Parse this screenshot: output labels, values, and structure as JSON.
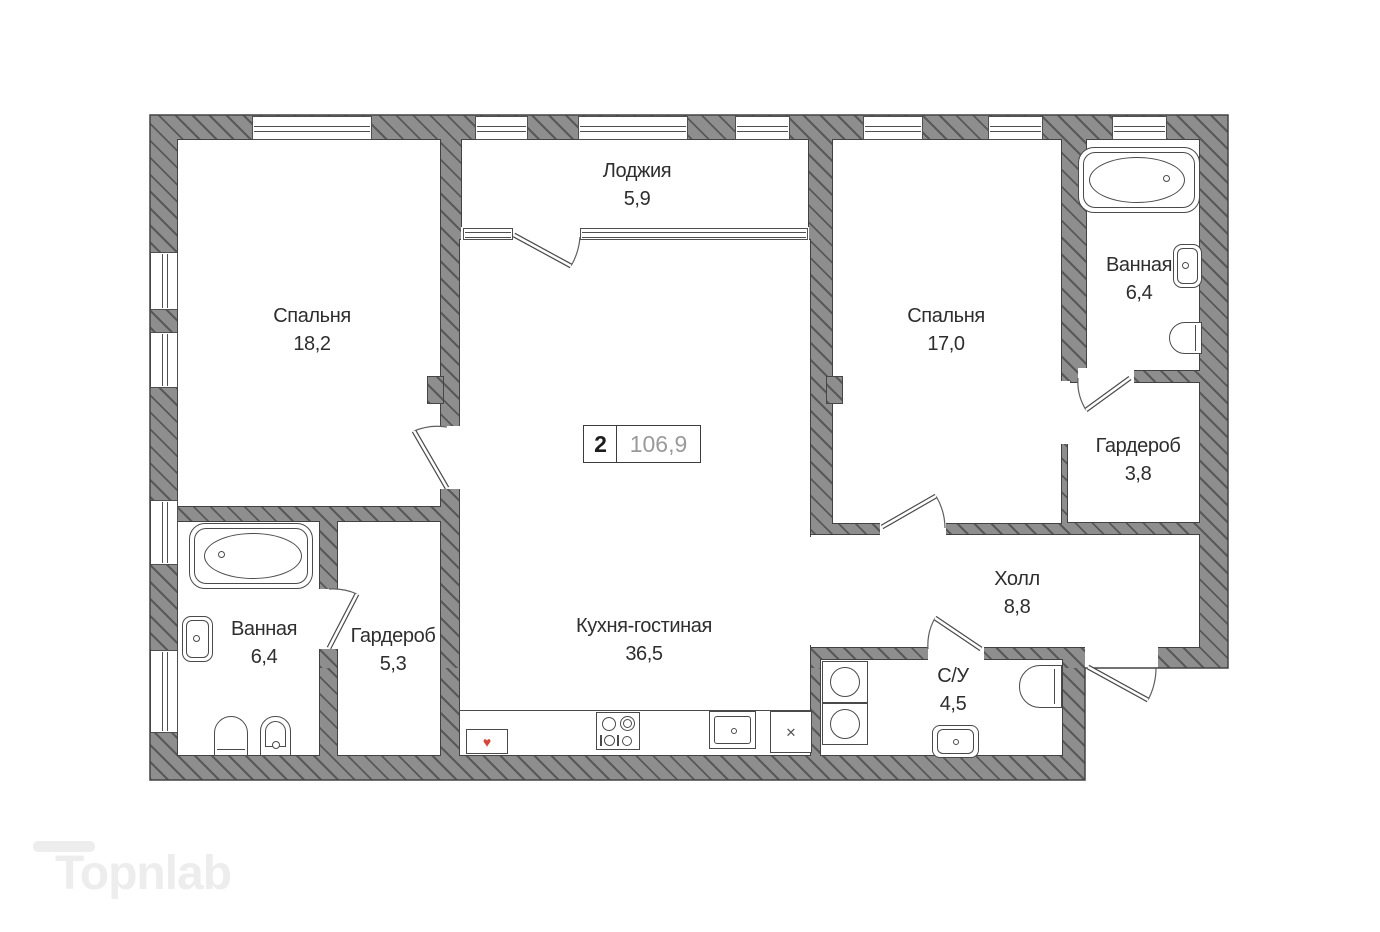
{
  "plan": {
    "badge": {
      "rooms": "2",
      "total_area": "106,9"
    },
    "rooms": [
      {
        "name": "Спальня",
        "area": "18,2"
      },
      {
        "name": "Лоджия",
        "area": "5,9"
      },
      {
        "name": "Спальня",
        "area": "17,0"
      },
      {
        "name": "Ванная",
        "area": "6,4"
      },
      {
        "name": "Гардероб",
        "area": "3,8"
      },
      {
        "name": "Холл",
        "area": "8,8"
      },
      {
        "name": "Ванная",
        "area": "6,4"
      },
      {
        "name": "Гардероб",
        "area": "5,3"
      },
      {
        "name": "Кухня-гостиная",
        "area": "36,5"
      },
      {
        "name": "С/У",
        "area": "4,5"
      }
    ],
    "symbols": {
      "x_appliance": "✕",
      "boiler": "♥"
    },
    "watermark": "Topnlab",
    "colors": {
      "wall": "#8e8e8e",
      "hatch_line": "#4e4e4e",
      "outline": "#434343",
      "label_text": "#2e2e2e",
      "badge_area_text": "#9a9a9a",
      "accent_red": "#d6453a",
      "watermark": "#ededed"
    }
  }
}
